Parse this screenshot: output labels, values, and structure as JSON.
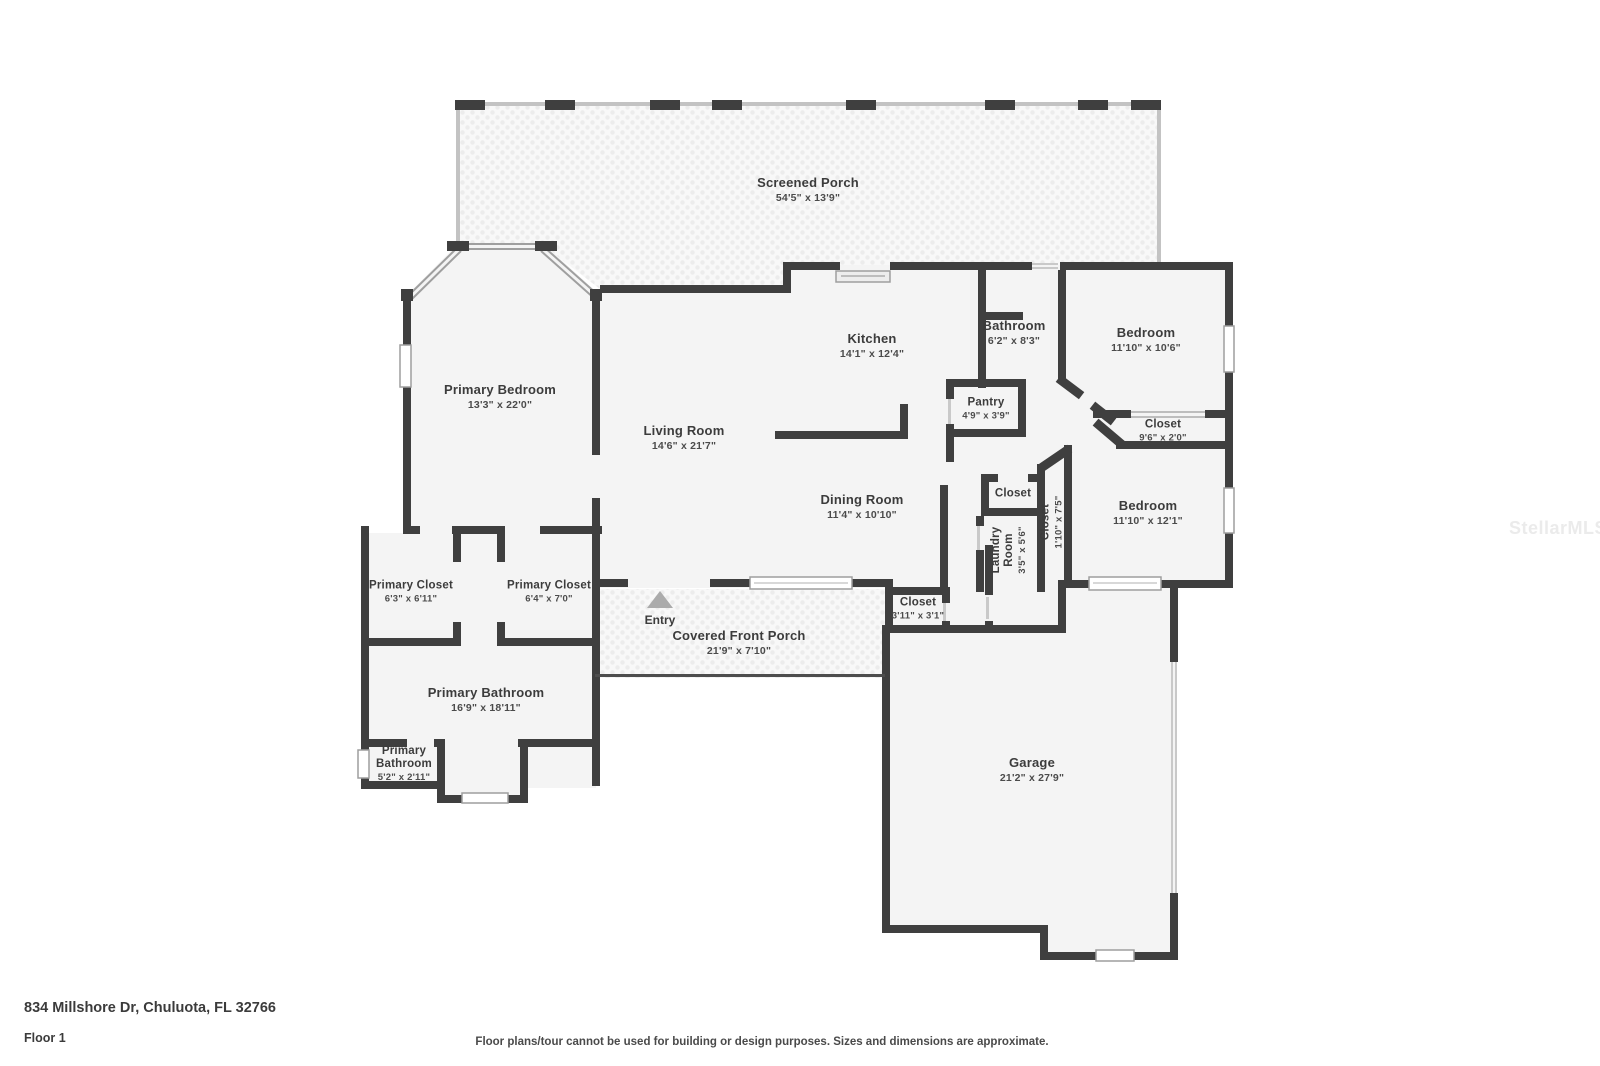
{
  "watermark": "StellarMLS",
  "footer": {
    "address": "834 Millshore Dr, Chuluota, FL 32766",
    "floor_label": "Floor 1",
    "disclaimer": "Floor plans/tour cannot be used for building or design purposes. Sizes and dimensions are approximate."
  },
  "entry": {
    "label": "Entry"
  },
  "rooms": {
    "screened_porch": {
      "name": "Screened Porch",
      "dims": "54'5\" x 13'9\""
    },
    "primary_bedroom": {
      "name": "Primary Bedroom",
      "dims": "13'3\" x 22'0\""
    },
    "kitchen": {
      "name": "Kitchen",
      "dims": "14'1\" x 12'4\""
    },
    "bathroom": {
      "name": "Bathroom",
      "dims": "6'2\" x 8'3\""
    },
    "bedroom_top": {
      "name": "Bedroom",
      "dims": "11'10\" x 10'6\""
    },
    "pantry": {
      "name": "Pantry",
      "dims": "4'9\" x 3'9\""
    },
    "closet_wide": {
      "name": "Closet",
      "dims": "9'6\" x 2'0\""
    },
    "living_room": {
      "name": "Living Room",
      "dims": "14'6\" x 21'7\""
    },
    "dining_room": {
      "name": "Dining Room",
      "dims": "11'4\" x 10'10\""
    },
    "closet_small": {
      "name": "Closet"
    },
    "laundry": {
      "name": "Laundry Room",
      "dims": "3'5\" x 5'6\""
    },
    "closet_tall": {
      "name": "Closet",
      "dims": "1'10\" x 7'5\""
    },
    "bedroom_bottom": {
      "name": "Bedroom",
      "dims": "11'10\" x 12'1\""
    },
    "primary_closet_left": {
      "name": "Primary Closet",
      "dims": "6'3\" x 6'11\""
    },
    "primary_closet_right": {
      "name": "Primary Closet",
      "dims": "6'4\" x 7'0\""
    },
    "covered_front_porch": {
      "name": "Covered Front Porch",
      "dims": "21'9\" x 7'10\""
    },
    "closet_entry": {
      "name": "Closet",
      "dims": "3'11\" x 3'1\""
    },
    "primary_bathroom": {
      "name": "Primary Bathroom",
      "dims": "16'9\" x 18'11\""
    },
    "primary_bathroom_small": {
      "name": "Primary Bathroom",
      "dims": "5'2\" x 2'11\""
    },
    "garage": {
      "name": "Garage",
      "dims": "21'2\" x 27'9\""
    }
  },
  "colors": {
    "wall": "#3f3f3f",
    "room_fill": "#f4f4f4",
    "porch_fill": "#f8f8f8",
    "porch_dot": "#ececec",
    "screen_wall": "#c3c3c3",
    "window_frame": "#9e9e9e",
    "label_text": "#3c3c3c",
    "dims_text": "#4b4b4b",
    "watermark_text": "#ebebeb"
  }
}
